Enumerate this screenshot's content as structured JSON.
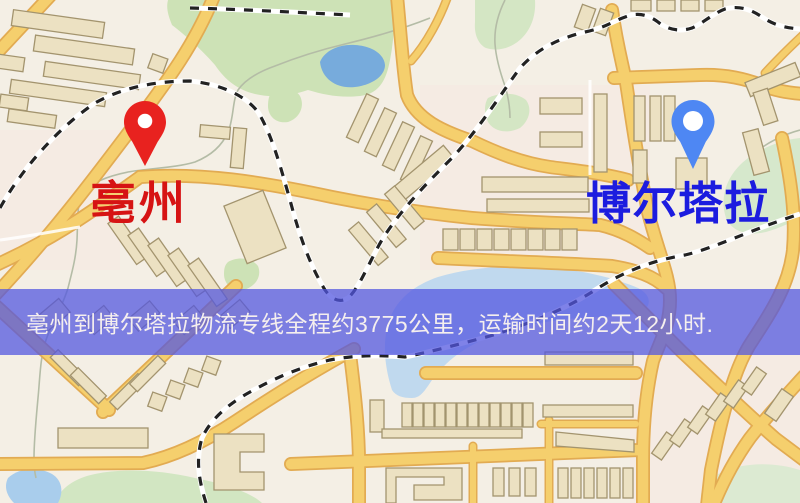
{
  "map": {
    "markers": [
      {
        "id": "origin",
        "label": "亳州",
        "label_color": "#d61313",
        "pin_color": "#e8221f",
        "icon": "map-pin-icon"
      },
      {
        "id": "destination",
        "label": "博尔塔拉",
        "label_color": "#1c1cdf",
        "pin_color": "#4e87f3",
        "icon": "map-pin-icon"
      }
    ],
    "palette": {
      "background": "#f4efe5",
      "road_fill": "#f5cf6d",
      "road_casing": "#e2ab52",
      "building_fill": "#ece1c2",
      "building_stroke": "#a3946e",
      "park_green": "#cfe3b8",
      "lake_blue": "#77abdc",
      "water_light": "#bdd7ee",
      "railway_dash": "#222222"
    }
  },
  "banner": {
    "text": "亳州到博尔塔拉物流专线全程约3775公里，运输时间约2天12小时.",
    "background": "rgba(82,86,224,0.74)",
    "text_color": "#f5efee"
  },
  "route": {
    "origin": "亳州",
    "destination": "博尔塔拉",
    "distance_text": "约3775公里",
    "duration_text": "约2天12小时"
  }
}
